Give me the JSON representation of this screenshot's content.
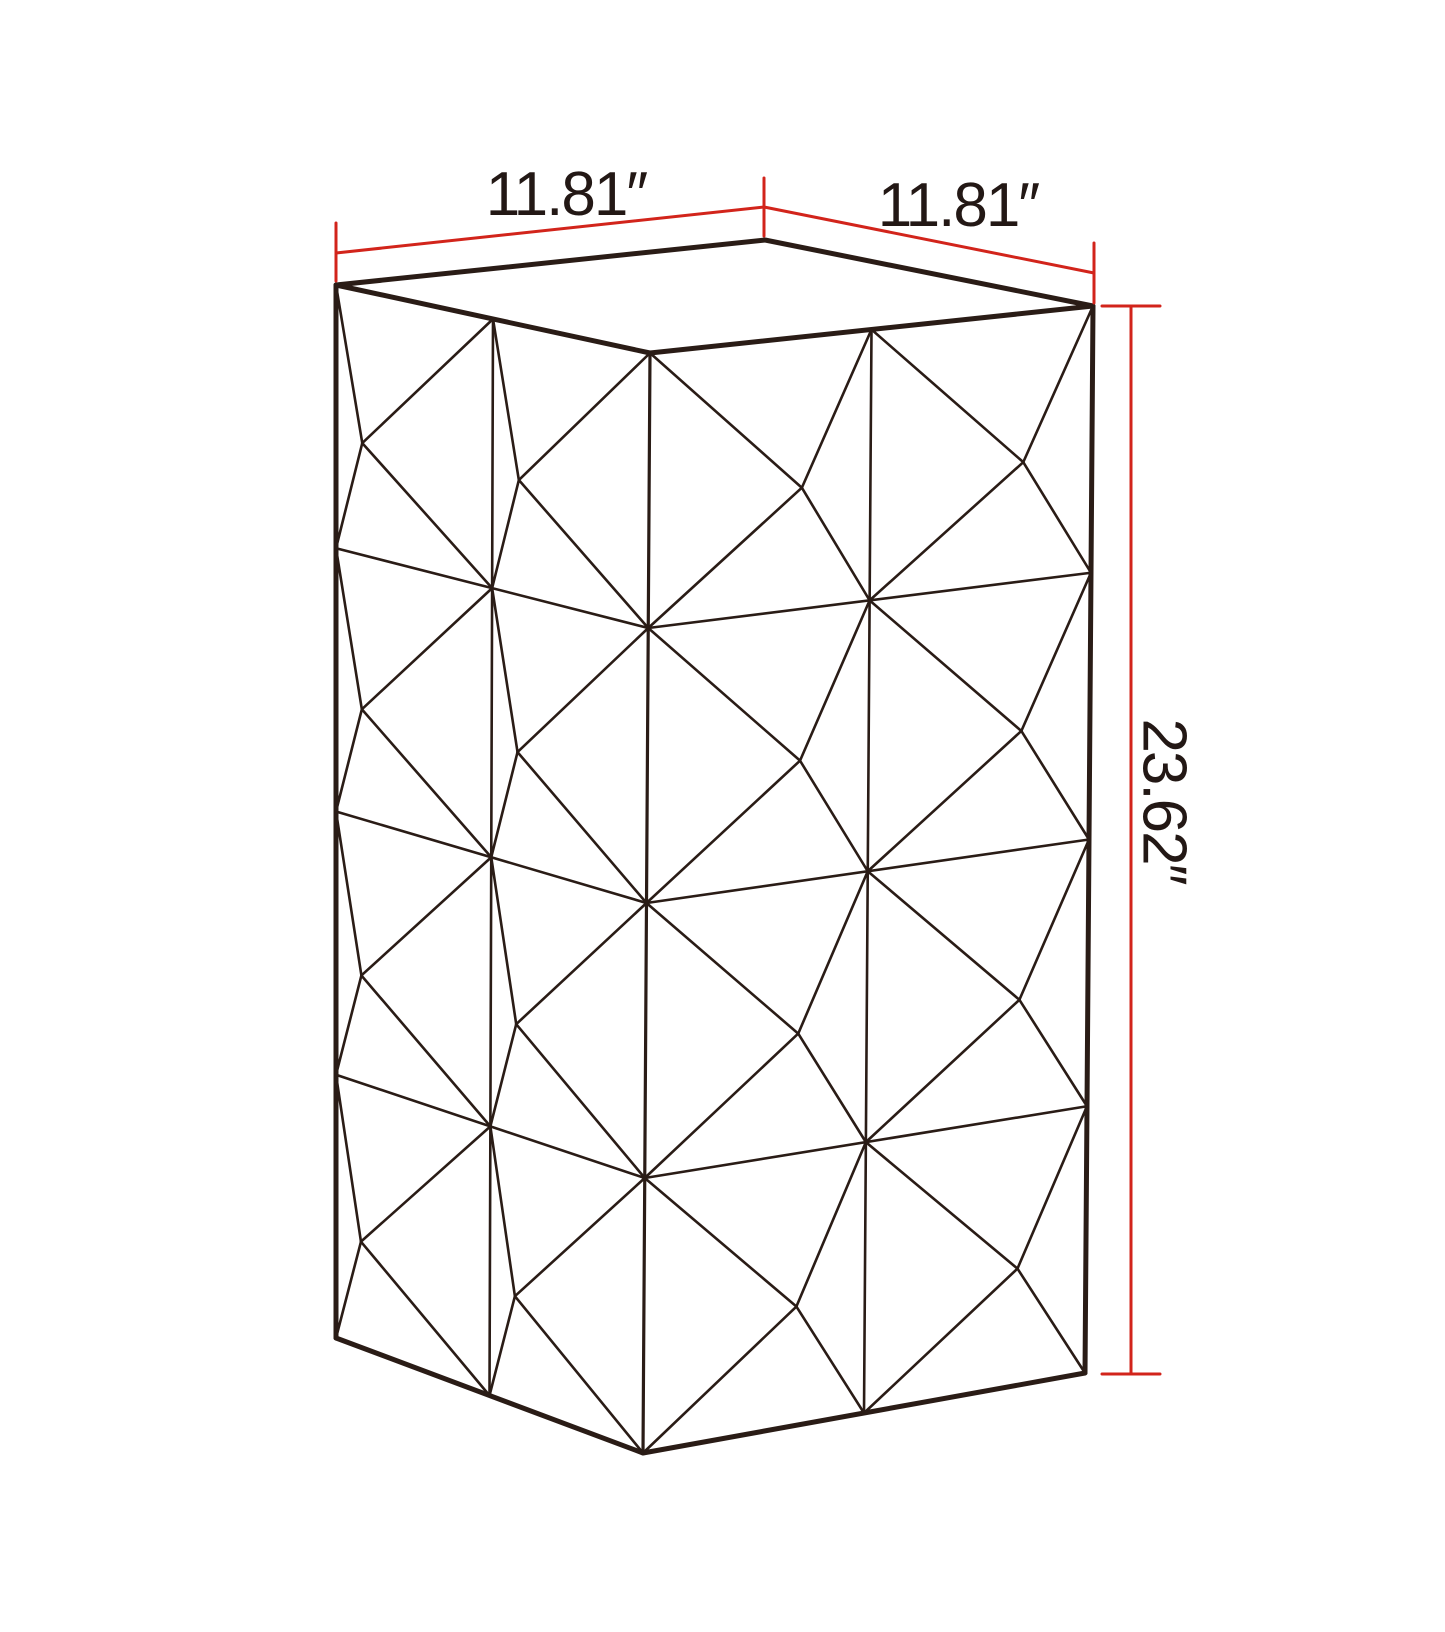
{
  "page": {
    "kind": "product-dimension-diagram",
    "object": "faceted-diamond-pedestal-column",
    "background": "#ffffff"
  },
  "figure": {
    "colors": {
      "line": "#2a1c16",
      "text": "#231815",
      "dimension": "#d2241b",
      "top_face_fill": "#ffffff"
    },
    "stroke_widths": {
      "outline": 5,
      "front_edge": 3.2,
      "facet": 2.6,
      "dimension": 3
    },
    "top_face": [
      [
        336,
        285
      ],
      [
        765,
        240
      ],
      [
        1093,
        306
      ],
      [
        650,
        353
      ]
    ],
    "faces": [
      {
        "name": "left-face",
        "quad": [
          [
            336,
            285
          ],
          [
            650,
            353
          ],
          [
            643,
            1453
          ],
          [
            336,
            1338
          ]
        ],
        "cols": 2,
        "rows": 4,
        "apex_offset": [
          -52,
          8
        ]
      },
      {
        "name": "right-face",
        "quad": [
          [
            650,
            353
          ],
          [
            1093,
            306
          ],
          [
            1085,
            1373
          ],
          [
            643,
            1453
          ]
        ],
        "cols": 2,
        "rows": 4,
        "apex_offset": [
          42,
          10
        ]
      }
    ],
    "outline_edges": [
      {
        "name": "left-edge",
        "from": [
          336,
          285
        ],
        "to": [
          336,
          1338
        ],
        "width": 5
      },
      {
        "name": "front-edge",
        "from": [
          650,
          353
        ],
        "to": [
          643,
          1453
        ],
        "width": 3.2
      },
      {
        "name": "right-edge",
        "from": [
          1093,
          306
        ],
        "to": [
          1085,
          1373
        ],
        "width": 5
      },
      {
        "name": "bottom-left-edge",
        "from": [
          336,
          1338
        ],
        "to": [
          643,
          1453
        ],
        "width": 5
      },
      {
        "name": "bottom-right-edge",
        "from": [
          643,
          1453
        ],
        "to": [
          1085,
          1373
        ],
        "width": 5
      }
    ]
  },
  "dimensions": {
    "top_left": {
      "label": "11.81″",
      "value_inches": 11.81,
      "line": [
        [
          336,
          253
        ],
        [
          764,
          207
        ]
      ],
      "ticks": [
        [
          [
            336,
            223
          ],
          [
            336,
            281
          ]
        ],
        [
          [
            764,
            178
          ],
          [
            764,
            236
          ]
        ]
      ],
      "label_pos": [
        566,
        215
      ]
    },
    "top_right": {
      "label": "11.81″",
      "value_inches": 11.81,
      "line": [
        [
          764,
          207
        ],
        [
          1094,
          273
        ]
      ],
      "ticks": [
        [
          [
            1094,
            243
          ],
          [
            1094,
            303
          ]
        ]
      ],
      "label_pos": [
        958,
        226
      ]
    },
    "height": {
      "label": "23.62″",
      "value_inches": 23.62,
      "line": [
        [
          1131,
          306
        ],
        [
          1131,
          1374
        ]
      ],
      "ticks": [
        [
          [
            1102,
            306
          ],
          [
            1160,
            306
          ]
        ],
        [
          [
            1102,
            1374
          ],
          [
            1160,
            1374
          ]
        ]
      ],
      "label_pos": [
        1164,
        801
      ],
      "rotation_deg": 90
    }
  }
}
